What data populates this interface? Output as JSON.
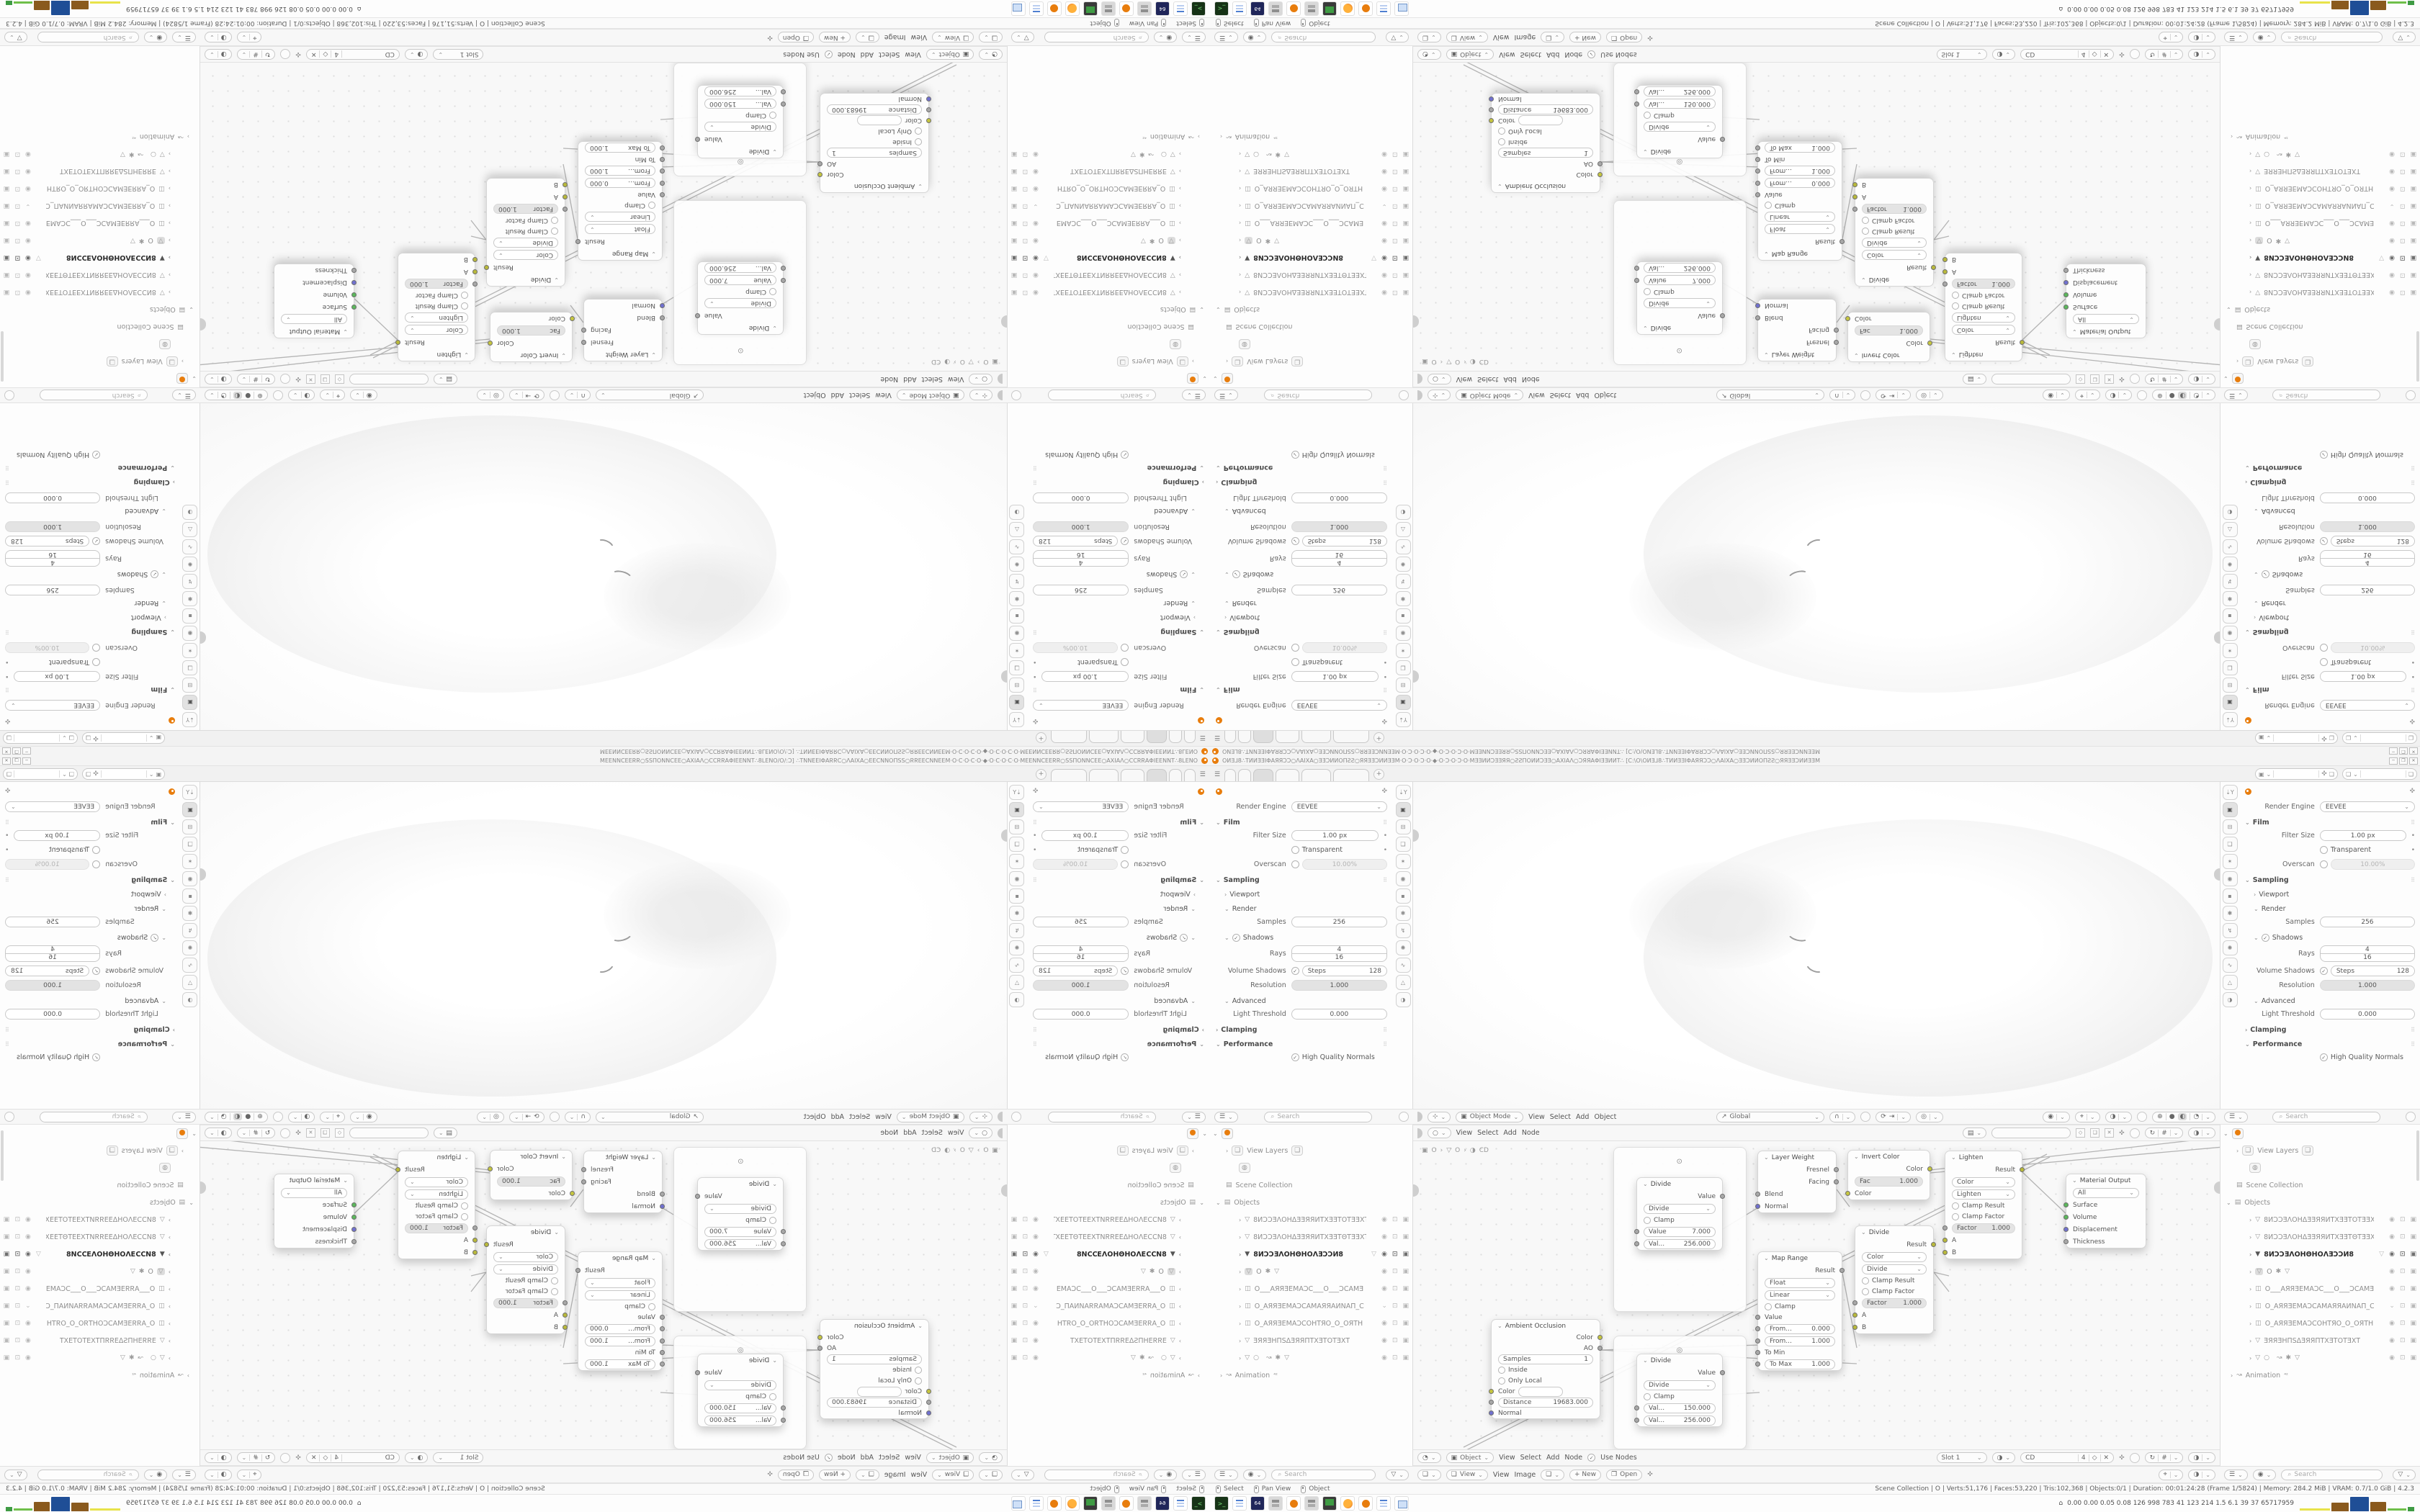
{
  "window": {
    "title": "ОИƎ⅃8∴ТИИƎƎІΦАЯЯƆƆ○ΛАІХА○ƎƎƆИИОΠƧƧ○ЯЯƎƎƆИИƎƎМ·О·Ɔ·О·Ɔ·О·◆·О·Ɔ·О·Ɔ·О·МƎƎИИƆƎƎЯЯ○ƧƧΠОИИƆƎƎ○АХІАΛ○ƆЯЯАΦІƎƎИИТ∴ [С:\\О\\ОИƎ⅃8∴ТИИƎƎІΦАЯЯƆƆ○ΛАІХА○ƎƎƆИИОΠƧƧ○ЯЯƎƎƆИИƎƎМ",
    "minimize": "─",
    "maximize": "❐",
    "close": "✕"
  },
  "topbar": {
    "menu_icon": "☰",
    "add_tab": "+"
  },
  "props": {
    "render_engine_label": "Render Engine",
    "render_engine": "EEVEE",
    "film": "Film",
    "filter_size": "Filter Size",
    "filter_size_v": "1.00 px",
    "transparent": "Transparent",
    "overscan": "Overscan",
    "overscan_v": "10.00%",
    "sampling": "Sampling",
    "viewport": "Viewport",
    "render": "Render",
    "samples": "Samples",
    "samples_v": "256",
    "shadows": "Shadows",
    "rays": "Rays",
    "rays_v": "4",
    "steps": "Steps",
    "steps_v": "16",
    "volume_shadows": "Volume Shadows",
    "vol_steps": "Steps",
    "vol_steps_v": "128",
    "resolution": "Resolution",
    "resolution_v": "1.000",
    "advanced": "Advanced",
    "light_threshold": "Light Threshold",
    "light_threshold_v": "0.000",
    "clamping": "Clamping",
    "performance": "Performance",
    "hq_normals": "High Quality Normals",
    "search": "Search",
    "tab_icons": [
      "⇣Y",
      "▣",
      "⊟",
      "❏",
      "✶",
      "◉",
      "▪",
      "✱",
      "↯",
      "✺",
      "∿",
      "△",
      "◑"
    ]
  },
  "vp": {
    "mode": "Object Mode",
    "m1": "View",
    "m2": "Select",
    "m3": "Add",
    "m4": "Object",
    "orientation": "Global"
  },
  "node": {
    "m1": "View",
    "m2": "Select",
    "m3": "Add",
    "m4": "Node",
    "type": "Object",
    "use_nodes": "Use Nodes",
    "slot": "Slot 1",
    "mat": "CD",
    "users": "4",
    "bc1": "O",
    "bc2": "O",
    "bc3": "CD"
  },
  "img": {
    "view": "View",
    "m1": "View",
    "m2": "Image",
    "new": "+ New",
    "open": "Open"
  },
  "nodes": {
    "divide1": {
      "t": "Divide",
      "out": "Value",
      "op": "Divide",
      "clamp": "Clamp",
      "f1l": "Value",
      "f1v": "7.000",
      "f2l": "Val...",
      "f2v": "256.000"
    },
    "divide2": {
      "t": "Divide",
      "out": "Value",
      "op": "Divide",
      "clamp": "Clamp",
      "f1l": "Val...",
      "f1v": "150.000",
      "f2l": "Val...",
      "f2v": "256.000"
    },
    "ao": {
      "t": "Ambient Occlusion",
      "o1": "Color",
      "o2": "AO",
      "sl": "Samples",
      "sv": "1",
      "c1": "Inside",
      "c2": "Only Local",
      "in1": "Color",
      "dl": "Distance",
      "dv": "19683.000",
      "in3": "Normal"
    },
    "lw": {
      "t": "Layer Weight",
      "o1": "Fresnel",
      "o2": "Facing",
      "i1": "Blend",
      "i2": "Normal"
    },
    "mr": {
      "t": "Map Range",
      "out": "Result",
      "s1": "Float",
      "s2": "Linear",
      "clamp": "Clamp",
      "i1": "Value",
      "f1l": "From...",
      "f1v": "0.000",
      "f2l": "From...",
      "f2v": "1.000",
      "i2": "To Min",
      "f3l": "To Max",
      "f3v": "1.000"
    },
    "inv": {
      "t": "Invert Color",
      "out": "Color",
      "fl": "Fac",
      "fv": "1.000",
      "in1": "Color"
    },
    "div": {
      "t": "Divide",
      "out": "Result",
      "s1": "Color",
      "s2": "Divide",
      "c1": "Clamp Result",
      "c2": "Clamp Factor",
      "fl": "Factor",
      "fv": "1.000",
      "i1": "A",
      "i2": "B"
    },
    "lig": {
      "t": "Lighten",
      "out": "Result",
      "s1": "Color",
      "s2": "Lighten",
      "c1": "Clamp Result",
      "c2": "Clamp Factor",
      "fl": "Factor",
      "fv": "1.000",
      "i1": "A",
      "i2": "B"
    },
    "mo": {
      "t": "Material Output",
      "sel": "All",
      "i1": "Surface",
      "i2": "Volume",
      "i3": "Displacement",
      "i4": "Thickness"
    }
  },
  "outliner": {
    "view_layers": "View Layers",
    "scene_collection": "Scene Collection",
    "objects": "Objects",
    "animation": "Animation",
    "anim_badge": "⁴²",
    "search": "Search",
    "rows": [
      {
        "name": "8ИƆƆƎΛΟΗΔƎƎЯЯИΤΧƎƎΤΟΤƎƎΧΤ"
      },
      {
        "name": "8ИƆƆƎΛΟΗΔƎƎЯЯИΤΧƎƎΤΘΤƎƎΧΤ"
      },
      {
        "name": "8ИƆƆƎΛΟΗΘΗΟΛƎƆƆИ8"
      },
      {
        "name": "O"
      },
      {
        "name": "O___АЯЯƎEMАƆC___O___ƆCАMƎ"
      },
      {
        "name": "O_АЯЯƎEMАƆCAMАЯЯАИNАΠ_C"
      },
      {
        "name": "O_АЯЯƎEMАƆCOHTЯO_O_OЯTH"
      },
      {
        "name": "ƎЯЯƎHΠSΔƎЯЯΠΤΧƎΤΟΤƎΧΤ"
      },
      {
        "name": ""
      }
    ]
  },
  "status": {
    "h1": "Select",
    "h2": "Pan View",
    "h3": "Object",
    "stats": "Scene Collection | O | Verts:51,176 | Faces:53,220 | Tris:102,368 | Objects:0/1 | Duration: 00:01:24:28 (Frame 1/5824) | Memory: 284.2 MiB | VRAM: 0.7/1.0 GiB | 4.2.3"
  },
  "taskbar": {
    "metrics": "0.00 0.00 0.05 0.08  126  998  783   41   123  214  1.5   6.1   39    37  65717959",
    "floppy_label": "64"
  }
}
